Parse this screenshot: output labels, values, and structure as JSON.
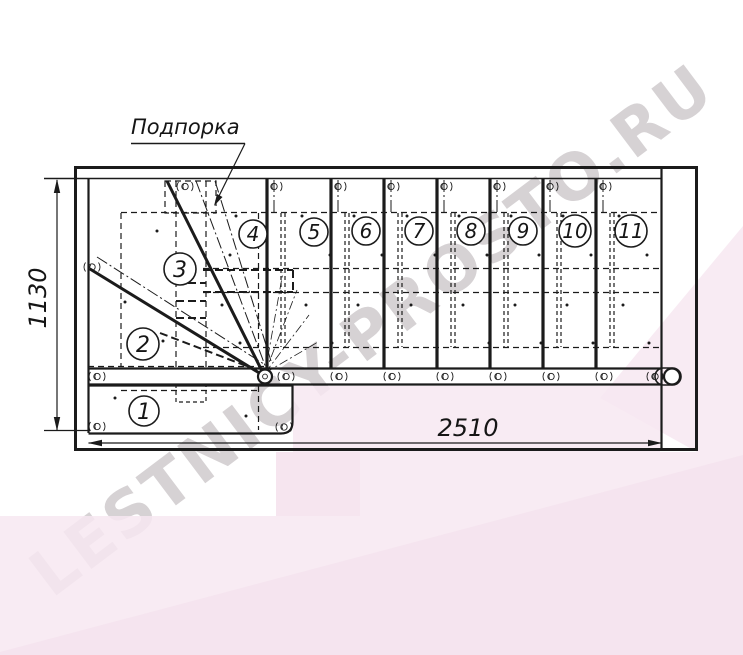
{
  "drawing": {
    "support_label": "Подпорка",
    "dimensions": {
      "height": "1130",
      "width": "2510"
    },
    "steps": [
      "1",
      "2",
      "3",
      "4",
      "5",
      "6",
      "7",
      "8",
      "9",
      "10",
      "11"
    ]
  },
  "watermark": {
    "text": "LESTNICY-PROSTO.RU",
    "color": "#d6d2d4"
  },
  "colors": {
    "line": "#1b1b1b",
    "pink_light": "#f7e8f1",
    "pink_mid": "#f3dfeb"
  }
}
